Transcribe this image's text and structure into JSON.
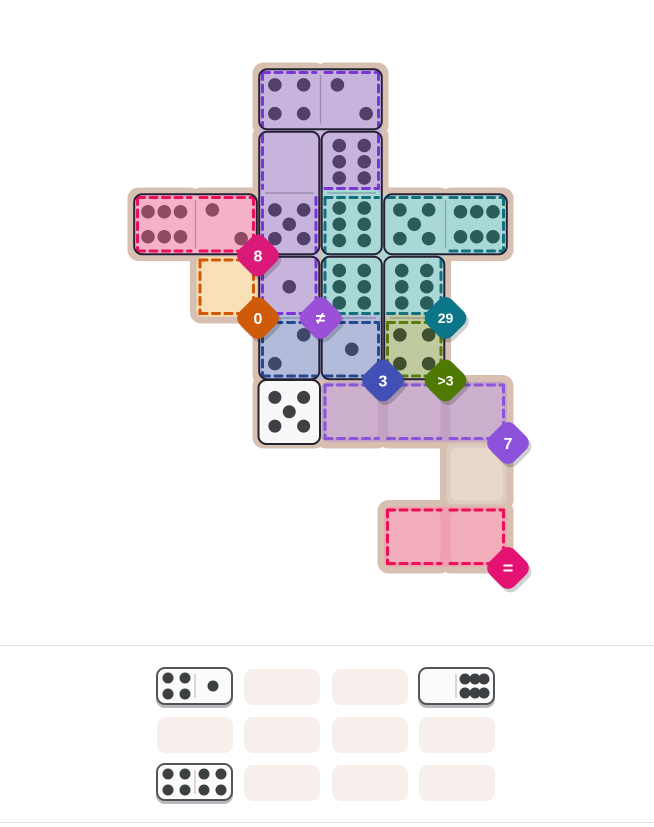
{
  "palette": {
    "page_bg": "#ffffff",
    "backing": "#d7c0b2",
    "free_cell_base": "#dfccc0",
    "free_cell_inner": "#e8d7cb",
    "empty_inner_highlight": "rgba(255,255,255,0.15)",
    "domino_outline": "#272138",
    "domino_divider": "rgba(50,35,70,0.28)",
    "white_tile_fill": "#f8f8f8",
    "white_tile_stroke": "#24242e",
    "white_tile_pip": "#3f3f44",
    "badge_text": "#ffffff",
    "badge_shadow": "rgba(0,0,0,0.18)",
    "tray_slot": "#f6efeb",
    "tray_domino_fill": "#fbfbfb",
    "tray_domino_stroke": "#53555a",
    "tray_domino_shadow": "#b9b9bd",
    "tray_domino_divider": "#ddd5d3",
    "tray_pip": "#3c4043",
    "divider_line": "#e0e0e0",
    "bottom_line": "#e3e3e3"
  },
  "board": {
    "regions": [
      {
        "name": "purple",
        "fill": "#c6b4dd",
        "dash": "#7a35d9",
        "pip": "#52406b",
        "cells": [
          [
            0,
            2
          ],
          [
            0,
            3
          ],
          [
            1,
            2
          ],
          [
            1,
            3
          ],
          [
            2,
            2
          ],
          [
            3,
            2
          ]
        ],
        "constraint": {
          "label": "≠",
          "color": "#9b50d8",
          "gx": 3,
          "gy": 4,
          "font": 17
        }
      },
      {
        "name": "pink",
        "fill": "#f4b2c7",
        "dash": "#ed0f5d",
        "pip": "#8f4a64",
        "cells": [
          [
            2,
            0
          ],
          [
            2,
            1
          ]
        ],
        "constraint": {
          "label": "8",
          "color": "#da1878",
          "gx": 2,
          "gy": 3,
          "font": 16
        }
      },
      {
        "name": "teal",
        "fill": "#a9d9d6",
        "dash": "#15707e",
        "pip": "#2a5c5c",
        "cells": [
          [
            2,
            3
          ],
          [
            2,
            4
          ],
          [
            2,
            5
          ],
          [
            3,
            3
          ],
          [
            3,
            4
          ]
        ],
        "constraint": {
          "label": "29",
          "color": "#0c7689",
          "gx": 5,
          "gy": 4,
          "font": 14
        }
      },
      {
        "name": "orange",
        "fill": "#f8dcab",
        "dash": "#d15608",
        "pip": "#7a5a28",
        "cells": [
          [
            3,
            1
          ]
        ],
        "constraint": {
          "label": "0",
          "color": "#cf5a0a",
          "gx": 2,
          "gy": 4,
          "font": 16
        }
      },
      {
        "name": "blue",
        "fill": "#b3bbdb",
        "dash": "#24498f",
        "pip": "#3f4866",
        "cells": [
          [
            4,
            2
          ],
          [
            4,
            3
          ]
        ],
        "constraint": {
          "label": "3",
          "color": "#4050b5",
          "gx": 4,
          "gy": 5,
          "font": 16
        }
      },
      {
        "name": "olive",
        "fill": "#bfcb9f",
        "dash": "#5a7a10",
        "pip": "#41502f",
        "cells": [
          [
            4,
            4
          ]
        ],
        "constraint": {
          "label": ">3",
          "color": "#4e7a04",
          "gx": 5,
          "gy": 5,
          "font": 14
        }
      },
      {
        "name": "mauve",
        "fill": "#c2a2c3",
        "dash": "#8a55d8",
        "pip": "#6b4a6b",
        "cells": [
          [
            5,
            3
          ],
          [
            5,
            4
          ],
          [
            5,
            5
          ]
        ],
        "constraint": {
          "label": "7",
          "color": "#8d52dc",
          "gx": 6,
          "gy": 6,
          "font": 16
        }
      },
      {
        "name": "rose",
        "fill": "#f09fb0",
        "dash": "#ea1154",
        "pip": "#8f4a64",
        "cells": [
          [
            7,
            4
          ],
          [
            7,
            5
          ]
        ],
        "constraint": {
          "label": "=",
          "color": "#e41373",
          "gx": 6,
          "gy": 8,
          "font": 18
        }
      }
    ],
    "free_cells": [
      [
        6,
        5
      ]
    ],
    "pips": [
      {
        "r": 0,
        "c": 2,
        "n": 4
      },
      {
        "r": 0,
        "c": 3,
        "n": 2
      },
      {
        "r": 1,
        "c": 2,
        "n": 0
      },
      {
        "r": 1,
        "c": 3,
        "n": 6,
        "six": "v"
      },
      {
        "r": 2,
        "c": 0,
        "n": 6,
        "six": "h"
      },
      {
        "r": 2,
        "c": 1,
        "n": 2
      },
      {
        "r": 2,
        "c": 2,
        "n": 5
      },
      {
        "r": 2,
        "c": 3,
        "n": 6,
        "six": "v"
      },
      {
        "r": 2,
        "c": 4,
        "n": 5
      },
      {
        "r": 2,
        "c": 5,
        "n": 6,
        "six": "h"
      },
      {
        "r": 3,
        "c": 2,
        "n": 1
      },
      {
        "r": 3,
        "c": 3,
        "n": 6,
        "six": "v"
      },
      {
        "r": 3,
        "c": 4,
        "n": 6,
        "six": "v"
      },
      {
        "r": 4,
        "c": 2,
        "n": 2,
        "diag": "up"
      },
      {
        "r": 4,
        "c": 3,
        "n": 1
      },
      {
        "r": 4,
        "c": 4,
        "n": 4
      }
    ],
    "dominoes": [
      {
        "a": [
          0,
          2
        ],
        "b": [
          0,
          3
        ],
        "pips": "4-2"
      },
      {
        "a": [
          1,
          2
        ],
        "b": [
          2,
          2
        ],
        "pips": "0-5"
      },
      {
        "a": [
          1,
          3
        ],
        "b": [
          2,
          3
        ],
        "pips": "6-6"
      },
      {
        "a": [
          2,
          0
        ],
        "b": [
          2,
          1
        ],
        "pips": "6-2"
      },
      {
        "a": [
          2,
          4
        ],
        "b": [
          2,
          5
        ],
        "pips": "5-6"
      },
      {
        "a": [
          3,
          2
        ],
        "b": [
          4,
          2
        ],
        "pips": "1-2"
      },
      {
        "a": [
          3,
          3
        ],
        "b": [
          4,
          3
        ],
        "pips": "6-1"
      },
      {
        "a": [
          3,
          4
        ],
        "b": [
          4,
          4
        ],
        "pips": "6-4"
      }
    ],
    "fixed_tile": {
      "r": 5,
      "c": 2,
      "n": 5
    }
  },
  "tray": {
    "rows": 3,
    "cols": 4,
    "dominoes": [
      {
        "row": 0,
        "col": 0,
        "left": 4,
        "right": 1
      },
      {
        "row": 0,
        "col": 3,
        "left": 0,
        "right": 6
      },
      {
        "row": 2,
        "col": 0,
        "left": 4,
        "right": 4
      }
    ]
  }
}
